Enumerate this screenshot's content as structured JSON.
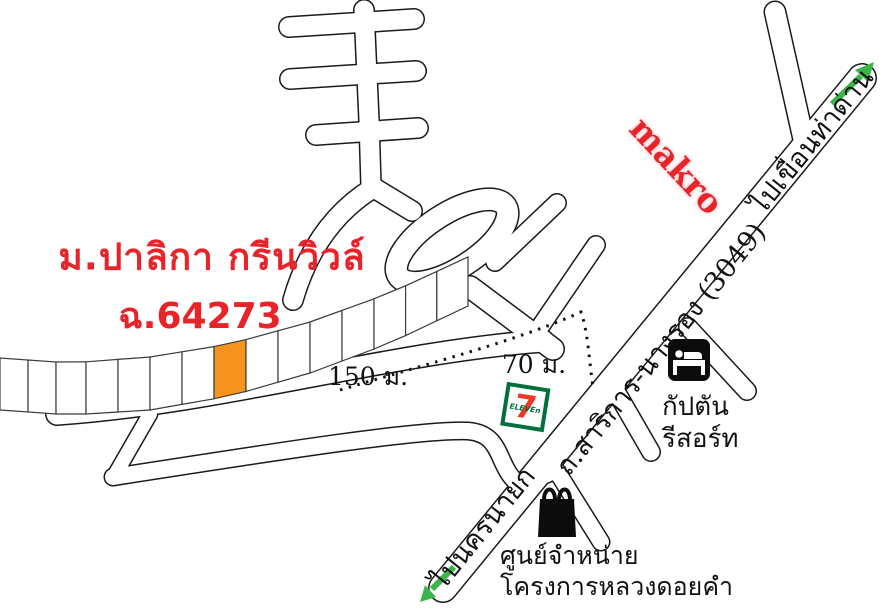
{
  "map": {
    "title_line1": "ม.ปาลิกา กรีนวิวล์",
    "title_line2": "ฉ.64273",
    "makro_logo": "makro",
    "roads": {
      "main_road_label": "ถ.สาริการ-นางรอง (3049)",
      "to_dam_label": "ไปเขื่อนท่าด่าน",
      "to_nakhon_nayok_label": "ไปนครนายก"
    },
    "distances": {
      "d150": "150 ม.",
      "d70": "70 ม."
    },
    "pois": {
      "resort_line1": "กัปตัน",
      "resort_line2": "รีสอร์ท",
      "shop_line1": "ศูนย์จำหน่าย",
      "shop_line2": "โครงการหลวงดอยคำ",
      "seven_eleven_seven": "7",
      "seven_eleven_eleven": "ELEVEn"
    },
    "plots": {
      "count": 15,
      "highlight_index": 7
    },
    "colors": {
      "brand_red": "#e8232a",
      "arrow_green": "#3bb54a",
      "seven_green": "#00703c",
      "seven_orange": "#ee3a24",
      "plot_highlight": "#f7941d",
      "line_black": "#1a1a1a",
      "road_white": "#ffffff",
      "label_black": "#111111"
    }
  }
}
